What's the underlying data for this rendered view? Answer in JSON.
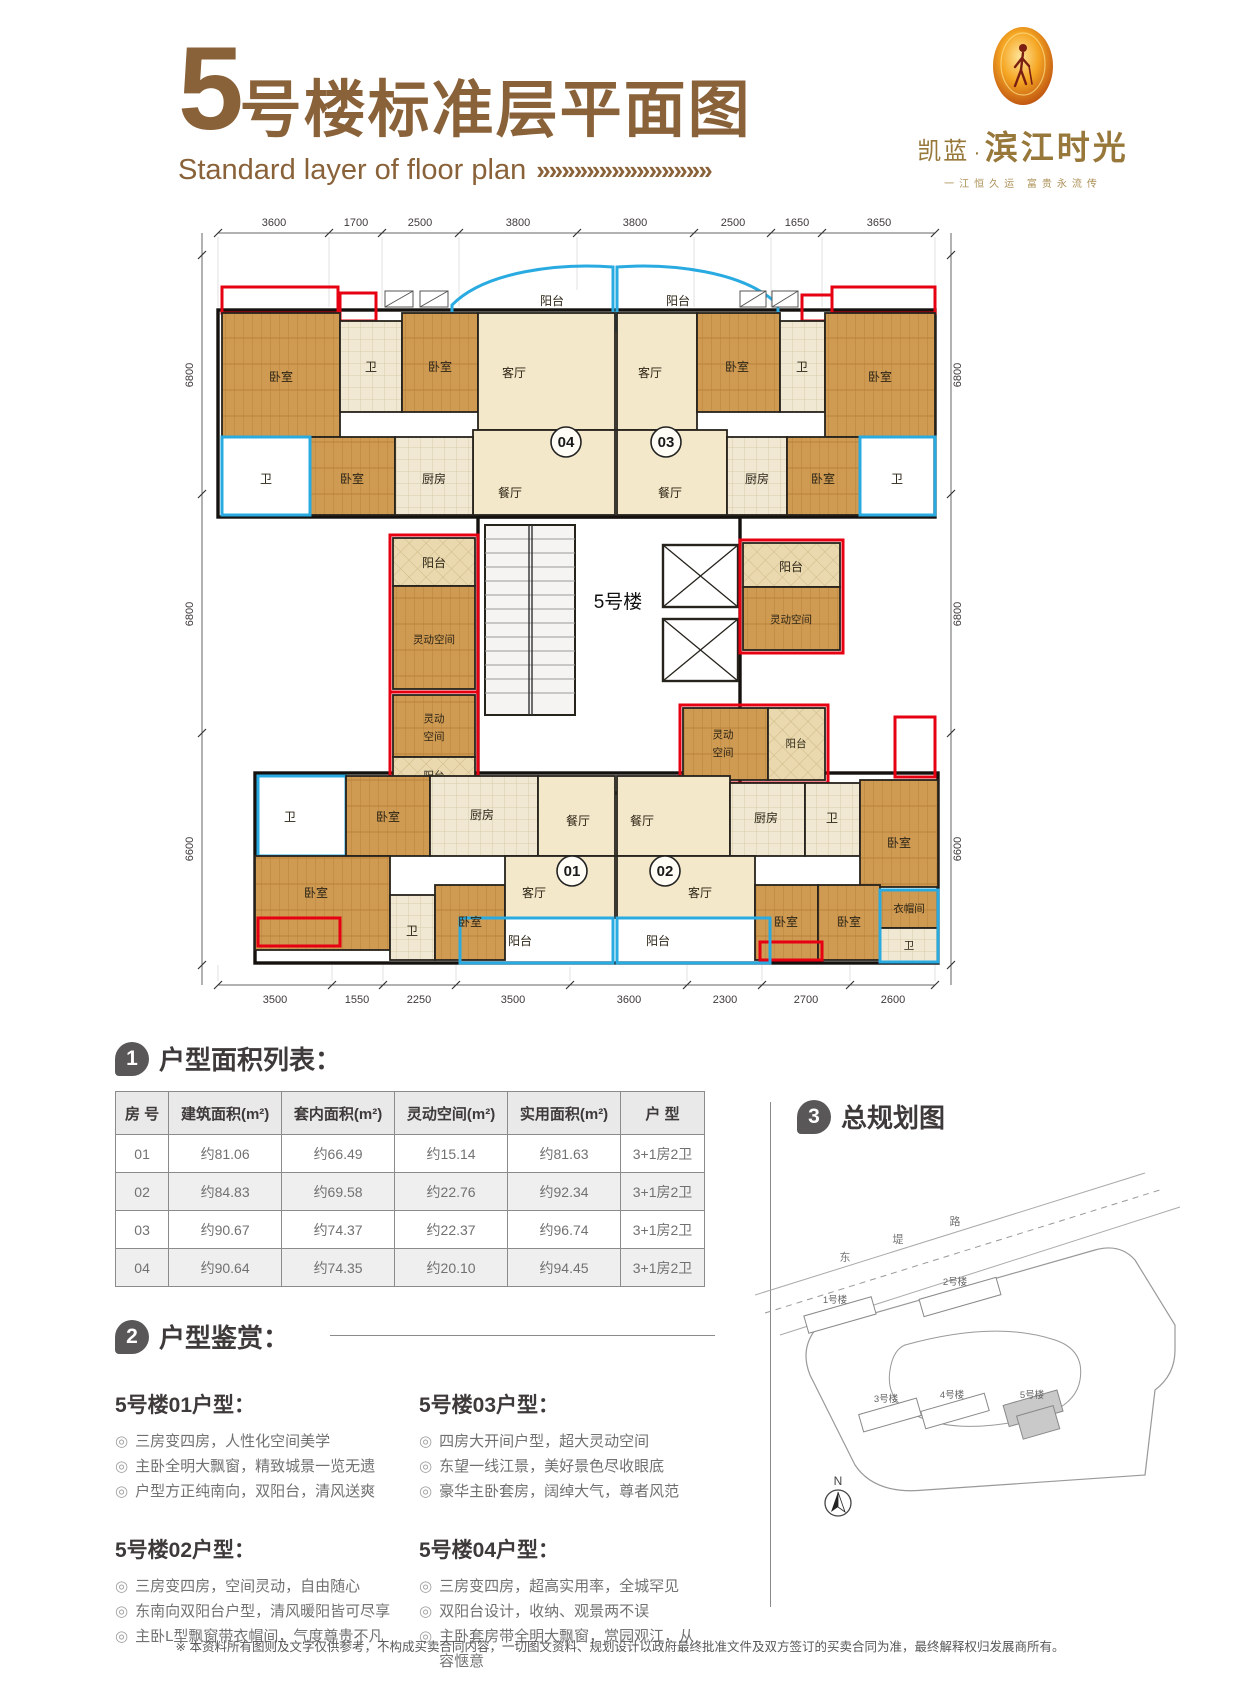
{
  "header": {
    "title_num": "5",
    "title_rest": "号楼标准层平面图",
    "subtitle": "Standard layer of floor plan",
    "chevrons": "»»»»»»»»»»»»»»",
    "logo": {
      "brand_small": "凯蓝",
      "brand_dot": "·",
      "brand_large": "滨江时光",
      "tagline": "一江恒久运 富贵永流传"
    }
  },
  "plan": {
    "building_label": "5号楼",
    "units": {
      "u01": "01",
      "u02": "02",
      "u03": "03",
      "u04": "04"
    },
    "rooms": {
      "bedroom": "卧室",
      "bath": "卫",
      "living": "客厅",
      "dining": "餐厅",
      "kitchen": "厨房",
      "balcony": "阳台",
      "flex": "灵动空间",
      "flex_l1": "灵动",
      "flex_l2": "空间",
      "cloakroom": "衣帽间"
    },
    "dims": {
      "top": [
        "3600",
        "1700",
        "2500",
        "3800",
        "3800",
        "2500",
        "1650",
        "3650"
      ],
      "bottom": [
        "3500",
        "1550",
        "2250",
        "3500",
        "3600",
        "2300",
        "2700",
        "2600"
      ],
      "left": [
        "6800",
        "6800",
        "6600"
      ],
      "right": [
        "6800",
        "6800",
        "6600"
      ]
    }
  },
  "area_table": {
    "badge": "1",
    "title": "户型面积列表：",
    "headers": [
      "房 号",
      "建筑面积(m²)",
      "套内面积(m²)",
      "灵动空间(m²)",
      "实用面积(m²)",
      "户 型"
    ],
    "rows": [
      [
        "01",
        "约81.06",
        "约66.49",
        "约15.14",
        "约81.63",
        "3+1房2卫"
      ],
      [
        "02",
        "约84.83",
        "约69.58",
        "约22.76",
        "约92.34",
        "3+1房2卫"
      ],
      [
        "03",
        "约90.67",
        "约74.37",
        "约22.37",
        "约96.74",
        "3+1房2卫"
      ],
      [
        "04",
        "约90.64",
        "约74.35",
        "约20.10",
        "约94.45",
        "3+1房2卫"
      ]
    ]
  },
  "review": {
    "badge": "2",
    "title": "户型鉴赏：",
    "bullet": "◎",
    "units": [
      {
        "title": "5号楼01户型：",
        "items": [
          "三房变四房，人性化空间美学",
          "主卧全明大飘窗，精致城景一览无遗",
          "户型方正纯南向，双阳台，清风送爽"
        ]
      },
      {
        "title": "5号楼02户型：",
        "items": [
          "三房变四房，空间灵动，自由随心",
          "东南向双阳台户型，清风暖阳皆可尽享",
          "主卧L型飘窗带衣帽间，气度尊贵不凡"
        ]
      },
      {
        "title": "5号楼03户型：",
        "items": [
          "四房大开间户型，超大灵动空间",
          "东望一线江景，美好景色尽收眼底",
          "豪华主卧套房，阔绰大气，尊者风范"
        ]
      },
      {
        "title": "5号楼04户型：",
        "items": [
          "三房变四房，超高实用率，全城罕见",
          "双阳台设计，收纳、观景两不误",
          "主卧套房带全明大飘窗，赏园观江，从容惬意"
        ]
      }
    ]
  },
  "siteplan": {
    "badge": "3",
    "title": "总规划图",
    "road": [
      "东",
      "堤",
      "路"
    ],
    "buildings": [
      "1号楼",
      "2号楼",
      "3号楼",
      "4号楼",
      "5号楼"
    ],
    "north": "N"
  },
  "footer": {
    "disclaimer": "※ 本资料所有图则及文字仅供参考，不构成买卖合同内容，一切图文资料、规划设计以政府最终批准文件及双方签订的买卖合同为准，最终解释权归发展商所有。"
  }
}
